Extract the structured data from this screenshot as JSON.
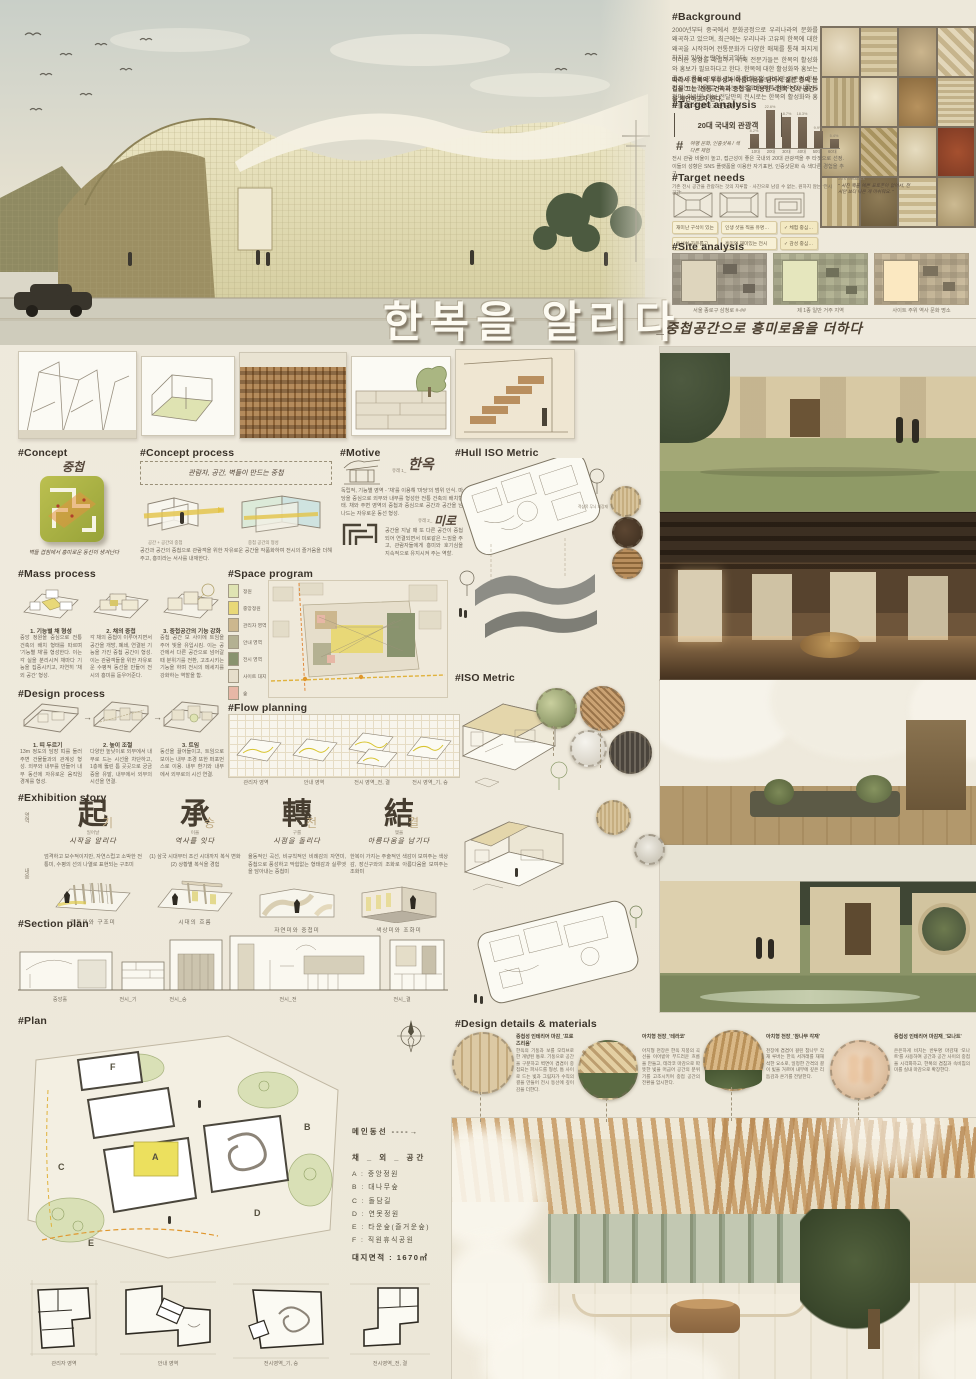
{
  "poster": {
    "title": "한복을 알리다",
    "subtitle": "_중첩공간으로 흥미로움을 더하다"
  },
  "background": {
    "heading": "#Background",
    "para1": "2000년부터 중국에서 문화공정으로 우리나라의 문화를 왜곡하고 있으며, 최근에는 우리나라 고유의 한복에 대한 왜곡을 시작하여 전통문화가 다양한 매체를 통해 퍼지게 하지고 있어 논란이 되고있다.",
    "para2": "이러한 상황을 해결하기 위해 전문가들은 한복의 활성화와 홍보가 필요하다고 한다. 한복에 대한 활성화와 홍보는 좋은 흐름을 공략할 전시를 통해 가능하지만 기존의 한복 전시는 눈길을 끌 수 없는 단조로운 작품관람의 전시를 원하며, 이러한 정보 전달만의 전시로는 한복의 활성화와 홍보를 할 수 없다고 판단된다.",
    "para3": "따라서 한복의 우수성과 아름다움을 담아서 젊은 층의 눈길을 끄는 '전통 건축과 중첩'을 이용한 <한복 전시 공간>을 제안하고자 한다."
  },
  "target_analysis": {
    "heading": "#Target analysis",
    "box_label": "20대 국내외 관광객",
    "hashtag": "#",
    "hand_note": "여행 문화, 인증샷욕 / 색다른 체험",
    "note": "전시 관람 비율이 높고, 접근성이 좋은 국내외 20대 관광객을 주 타겟으로 선정. 이들의 성향은 SNS 플랫폼을 이용한 자기표현, 인증샷문화 속 색다른 경험을 추구."
  },
  "chart_data": {
    "type": "bar",
    "title": "국내외 관광객 연령 비율",
    "categories": [
      "10대",
      "20대",
      "30대",
      "40대",
      "50대",
      "60대"
    ],
    "values": [
      8.2,
      22.6,
      18.7,
      18.3,
      9.9,
      5.4
    ],
    "value_labels": [
      "8.2%",
      "22.6%",
      "18.7%",
      "18.3%",
      "9.9%",
      "5.4%"
    ],
    "xlabel": "연령",
    "ylabel": "비율(%)",
    "ylim": [
      0,
      25
    ],
    "grid": false,
    "legend": "none"
  },
  "target_needs": {
    "heading": "#Target needs",
    "subnote": "기존 전시 공간을 관람하는 것의 지루함 · 사진으로 남길 수 없는, 원하지 않는 '전시 공간'",
    "needs_label": "20's needs",
    "feedback_label": "20's feedback",
    "quote": "\" 사진 찍을 예쁜 포토존이 없어서, 전시만 보다 나온 게 아쉬워요. \"",
    "tags_col1": [
      "재미난 구석이 있는",
      "동선이 자유롭고 쾌적한"
    ],
    "tags_col2": [
      "인생 샷을 찍을 유명한 포토스팟",
      "흥미와 재미있는 전시"
    ],
    "tags_col3": [
      "✓ 체험 중심 전시관",
      "✓ 감성 중심 전시관"
    ]
  },
  "site_analysis": {
    "heading": "#Site analysis",
    "captions": [
      "서울 종로구 삼청로 #-##",
      "제 1종 일반 거주 지역",
      "사이트 주위 역사 문화 명소"
    ]
  },
  "concept": {
    "heading": "#Concept",
    "hand_word": "중첩",
    "caption": "벽들 겹침에서 흥미로운 동선이 생겨난다"
  },
  "concept_process": {
    "heading": "#Concept process",
    "hand_note": "관람자, 공간, 벽들이 만드는 중첩",
    "diagram_captions": [
      "공간 + 공간의 중첩",
      "중첩 공간의 형성"
    ],
    "body": "공간과 공간의 중첩으로 관람객을 위한 자유로운 공간을 작품화하여 전시의 즐거움을 더해주고, 흥미라는 서사를 내재한다."
  },
  "motive": {
    "heading": "#Motive",
    "item1_tag": "유래 1_",
    "item1_word": "한옥",
    "item1_text": "독립적, 기능별 영역 - '채'를 이용해 '마당'의 범위 인식. 마당을 중심으로 외부와 내부를 형성한 전통 건축의 배치형태. 채와 주변 영역의 중첩과 중심으로 공간과 공간을 넘나드는 자유로운 동선 형성.",
    "item2_tag": "유래 2_",
    "item2_word": "미로",
    "item2_text": "공간을 지날 때 또 다른 공간이 중첩되어 연결되면서 미로같은 느낌을 주고, 관람자들에게 흥미와 호기심을 지속적으로 유지시켜 주는 역할."
  },
  "mass_process": {
    "heading": "#Mass process",
    "steps": [
      {
        "title": "1. 기능별 채 형성",
        "text": "중앙 정원을 중심으로 전통 건축의 배치 형태를 따르며 '기능별 채'를 형성한다. 이는 각 실을 분리시켜 채마다 기능을 집중시키고, 자연히 '채 외 공간' 형성."
      },
      {
        "title": "2. 채의 중첩",
        "text": "각 채의 중첩이 이루어지면서 공간을 개방, 폐쇄, 연결된 기능을 가진 중첩 공간이 형성. 이는 관람객들을 위한 자유로운 수평적 동선을 만들어 전시의 흥미를 돋우어준다."
      },
      {
        "title": "3. 중첩공간의 기능 강화",
        "text": "중첩 공간 보 사이에 트임을 주어 빛을 유입시킴. 이는 공간에서 다른 공간으로 넘어갈 때 분위기를 전환, 고조시키는 기능을 하며 전시의 메세지를 강화하는 역할을 함."
      }
    ]
  },
  "space_program": {
    "heading": "#Space program",
    "legend": [
      {
        "label": "정원",
        "color": "#dfe3b2"
      },
      {
        "label": "중앙정원",
        "color": "#e8d877"
      },
      {
        "label": "관리자 영역",
        "color": "#ccb78e"
      },
      {
        "label": "안내 영역",
        "color": "#b4b192"
      },
      {
        "label": "전시 영역",
        "color": "#89936e"
      },
      {
        "label": "사이트 대지",
        "color": "#e6decb"
      },
      {
        "label": "숲",
        "color": "#e7b7a6"
      }
    ]
  },
  "design_process": {
    "heading": "#Design process",
    "steps": [
      {
        "title": "1. 띠 두르기",
        "text": "13m 정도의 담장 띠를 둘러 주변 건물들과의 관계성 형성. 외부와 내부를 만들어 내부 동선에 자유로운 움직임 경계를 형성."
      },
      {
        "title": "2. 높이 조절",
        "text": "다양한 높낮이로 외부에서 내부로 드는 시선을 차단하고, 1층에 뚫린 틈 곳곳으로 궁금증을 유발, 내부에서 외부의 시선을 연결."
      },
      {
        "title": "3. 트임",
        "text": "동선을 끌어들이고, 트임으로 보이는 내부 조경 또한 퍼포먼스로 이용. 내부 환기와 내부에서 외부로의 시선 연결."
      }
    ]
  },
  "flow_planning": {
    "heading": "#Flow planning",
    "captions": [
      "관리자 영역",
      "안내 영역",
      "전시 영역_전, 결",
      "전시 영역_기, 승"
    ]
  },
  "exhibition_story": {
    "heading": "#Exhibition story",
    "row_labels": [
      "영역",
      "내용"
    ],
    "chapters": [
      {
        "hanja": "起",
        "hangul": "기",
        "gloss": "일어날",
        "tagline": "시작을 알리다",
        "body": "엄격하고 보수적이지만, 자연스럽고 소박한 전통미, 수평의 선의 나열로 표현되는 구조미",
        "caption": "전통미와 구조미"
      },
      {
        "hanja": "承",
        "hangul": "승",
        "gloss": "이을",
        "tagline": "역사를 잇다",
        "body": "(1) 삼국 시대부터 조선 시대까지 복식 변화 (2) 상황별 복식을 경험",
        "caption": "시대의 흐름"
      },
      {
        "hanja": "轉",
        "hangul": "전",
        "gloss": "구를",
        "tagline": "시점을 돌리다",
        "body": "율동적인 곡선, 비규칙적인 비례감의 자연미, 중첩으로 풍성하고 막힘없는 형태감과 실루엣을 담아내는 중첩미",
        "caption": "자연미와 중첩미"
      },
      {
        "hanja": "結",
        "hangul": "결",
        "gloss": "맺을",
        "tagline": "아름다움을 남기다",
        "body": "한복이 가지는 주술적인 색감이 보여주는 색상감, 장신구와의 조화로 아름다움을 보여주는 조화미",
        "caption": "색상미와 조화미"
      }
    ]
  },
  "section_plan": {
    "heading": "#Section plan",
    "captions": [
      "중앙홀",
      "전시_기",
      "전시_승",
      "전시_전",
      "전시_결"
    ]
  },
  "hull_iso": {
    "heading": "#Hull ISO Metric",
    "material_label": "적삼목 무늬 외장재"
  },
  "iso": {
    "heading": "#ISO Metric"
  },
  "plan": {
    "heading": "#Plan",
    "main_flow": "메인동선 ----→",
    "legend_title": "채 _ 외 _ 공간",
    "items": [
      "A : 중앙정원",
      "B : 대나무숲",
      "C : 돌담길",
      "D : 연못정원",
      "E : 타운숲(즐거운숲)",
      "F : 직원휴식공원"
    ],
    "area": "대지면적 : 1670㎡",
    "letters": [
      "A",
      "B",
      "C",
      "D",
      "E",
      "F"
    ],
    "small_captions": [
      "관리자 영역",
      "안내 영역",
      "전시영역_기, 승",
      "전시영역_전, 결"
    ]
  },
  "design_details": {
    "heading": "#Design details & materials",
    "items": [
      {
        "title": "중첩성 인테리어 마감_'프로즈리움'",
        "text": "한옥의 기둥과 보를 모티브로 한 개방된 통로. 기둥으로 공간을 구분하고 벽면이 겹겹이 중첩되는 파사드를 형성, 틈 사이로 드는 빛과 그림자가 수직의 결을 만들어 전시 동선에 깊이감을 더한다."
      },
      {
        "title": "아치형 천장_'테라코'",
        "text": "아치형 천장은 한옥 지붕의 곡선을 이어받아 부드러운 흐름을 만들고, 테라코 마감으로 따뜻한 빛을 머금어 공간의 분위기를 고조시키며 중첩 공간의 전환을 암시한다."
      },
      {
        "title": "아치형 천장_'참나무 각재'",
        "text": "천장에 겹겹이 걸린 참나무 각재 루버는 한옥 서까래를 재해석한 요소로, 일정한 간격의 결이 빛을 거르며 내부에 깊은 리듬감과 온기를 전달한다."
      },
      {
        "title": "중첩성 인테리어 마감재_'모나트'",
        "text": "은은하게 비치는 반투명 마감재 '모나트'를 사용하여 공간과 공간 사이의 중첩을 시각화하고, 한복의 겹침과 속비침의 미를 실내 마감으로 확장한다."
      }
    ]
  }
}
